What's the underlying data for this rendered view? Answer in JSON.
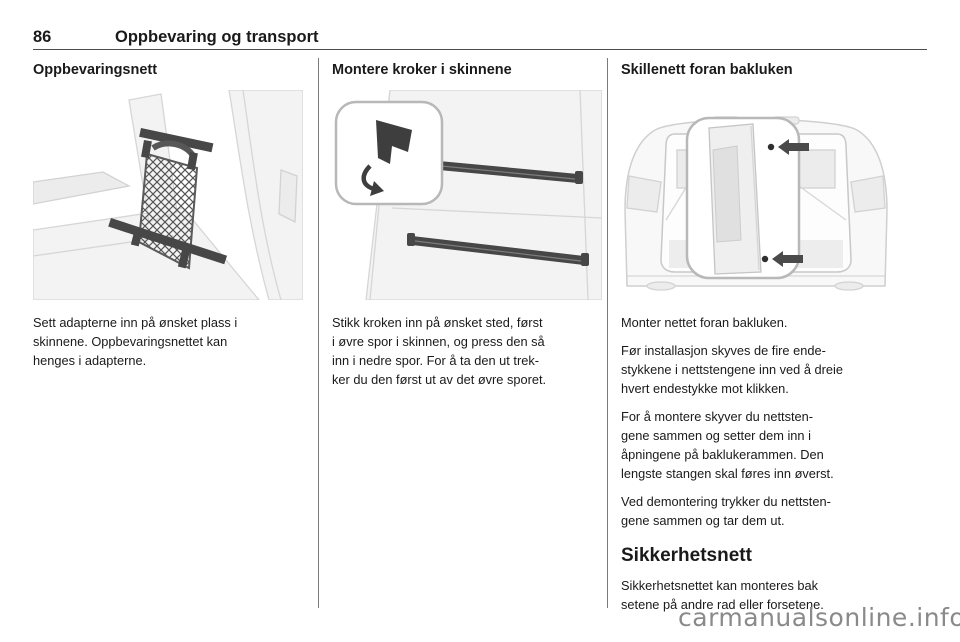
{
  "page": {
    "number": "86",
    "chapter_title": "Oppbevaring og transport",
    "watermark": "carmanualsonline.info"
  },
  "colors": {
    "text": "#1a1a1a",
    "header_rule": "#4d4d4d",
    "column_separator": "#7a7a7a",
    "watermark": "#8a8a8a",
    "illustration_dark": "#474747",
    "illustration_light": "#f3f3f3"
  },
  "icons": [
    "net-mesh",
    "rail-hook-icon",
    "curved-arrow-icon",
    "left-arrow-icon"
  ],
  "columns": [
    {
      "heading": "Oppbevaringsnett",
      "illustration": "cargo-net-between-rails",
      "paragraphs": [
        "Sett adapterne inn på ønsket plass i\nskinnene. Oppbevaringsnettet kan\nhenges i adapterne."
      ]
    },
    {
      "heading": "Montere kroker i skinnene",
      "illustration": "hook-installation-in-side-rails",
      "paragraphs": [
        "Stikk kroken inn på ønsket sted, først\ni øvre spor i skinnen, og press den så\ninn i nedre spor. For å ta den ut trek-\nker du den først ut av det øvre sporet."
      ]
    },
    {
      "heading": "Skillenett foran bakluken",
      "illustration": "net-in-front-of-tailgate",
      "paragraphs": [
        "Monter nettet foran bakluken.",
        "Før installasjon skyves de fire ende-\nstykkene i nettstengene inn ved å dreie\nhvert endestykke mot klikken.",
        "For å montere skyver du nettsten-\ngene sammen og setter dem inn i\nåpningene på baklukerammen. Den\nlengste stangen skal føres inn øverst.",
        "Ved demontering trykker du nettsten-\ngene sammen og tar dem ut."
      ],
      "subsection": {
        "heading": "Sikkerhetsnett",
        "paragraphs": [
          "Sikkerhetsnettet kan monteres bak\nsetene på andre rad eller forsetene."
        ]
      }
    }
  ]
}
